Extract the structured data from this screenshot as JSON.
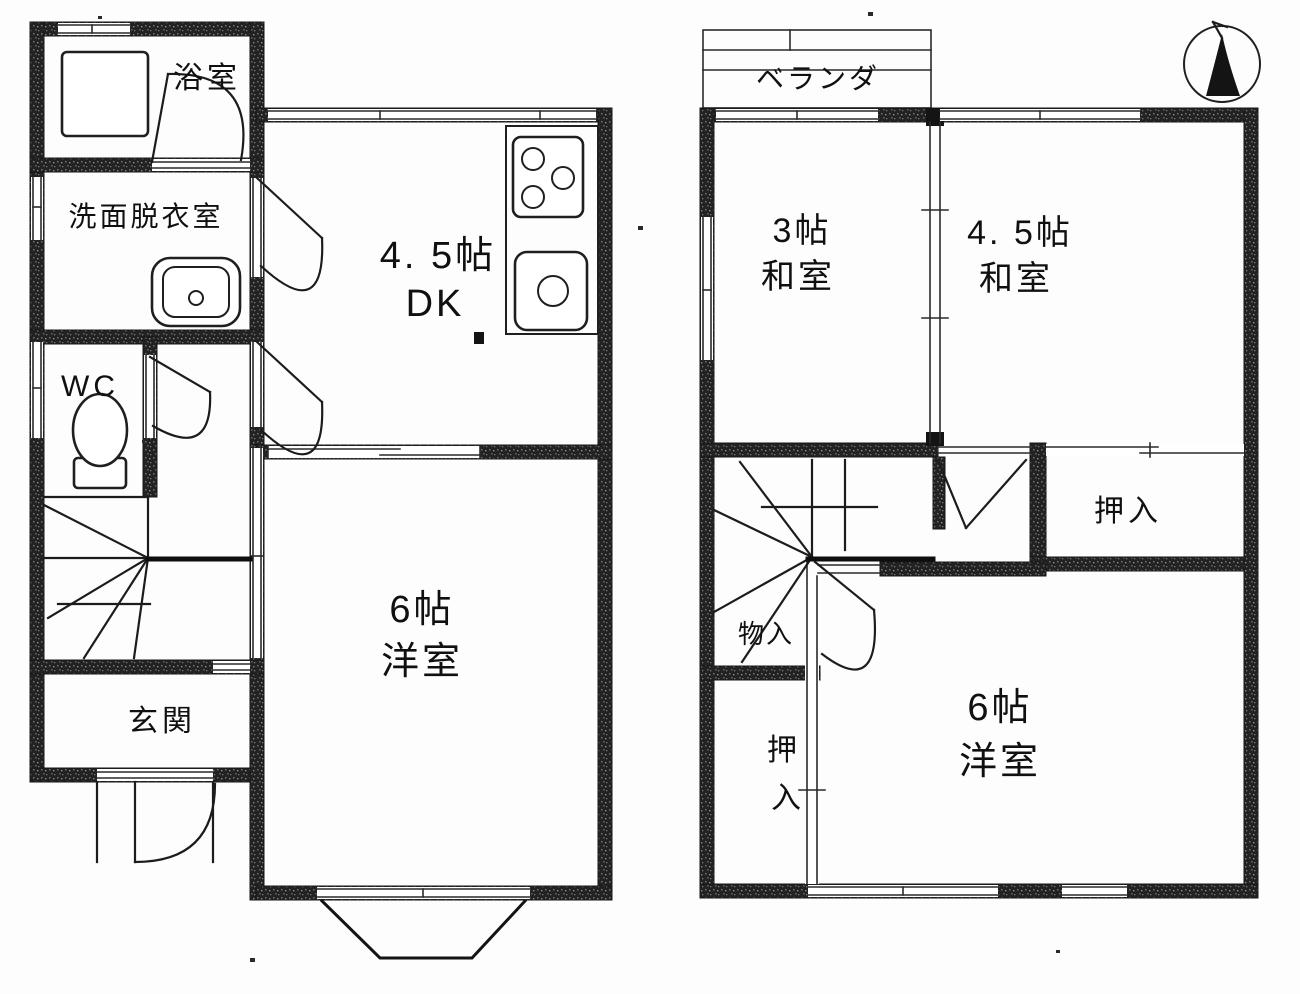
{
  "floorplan": {
    "floor1": {
      "bath": "浴室",
      "washroom": "洗面脱衣室",
      "wc": "WC",
      "entrance": "玄関",
      "dk_size": "4. 5帖",
      "dk_name": "DK",
      "western_size": "6帖",
      "western_name": "洋室"
    },
    "floor2": {
      "veranda": "ベランダ",
      "jp3_size": "3帖",
      "jp3_name": "和室",
      "jp45_size": "4. 5帖",
      "jp45_name": "和室",
      "closet_right": "押入",
      "storage": "物入",
      "closet_left_top": "押",
      "closet_left_bottom": "入",
      "western_size": "6帖",
      "western_name": "洋室"
    },
    "icons": {
      "compass": "north-arrow"
    },
    "colors": {
      "ink": "#161616",
      "paper": "#fdfdfd"
    }
  }
}
